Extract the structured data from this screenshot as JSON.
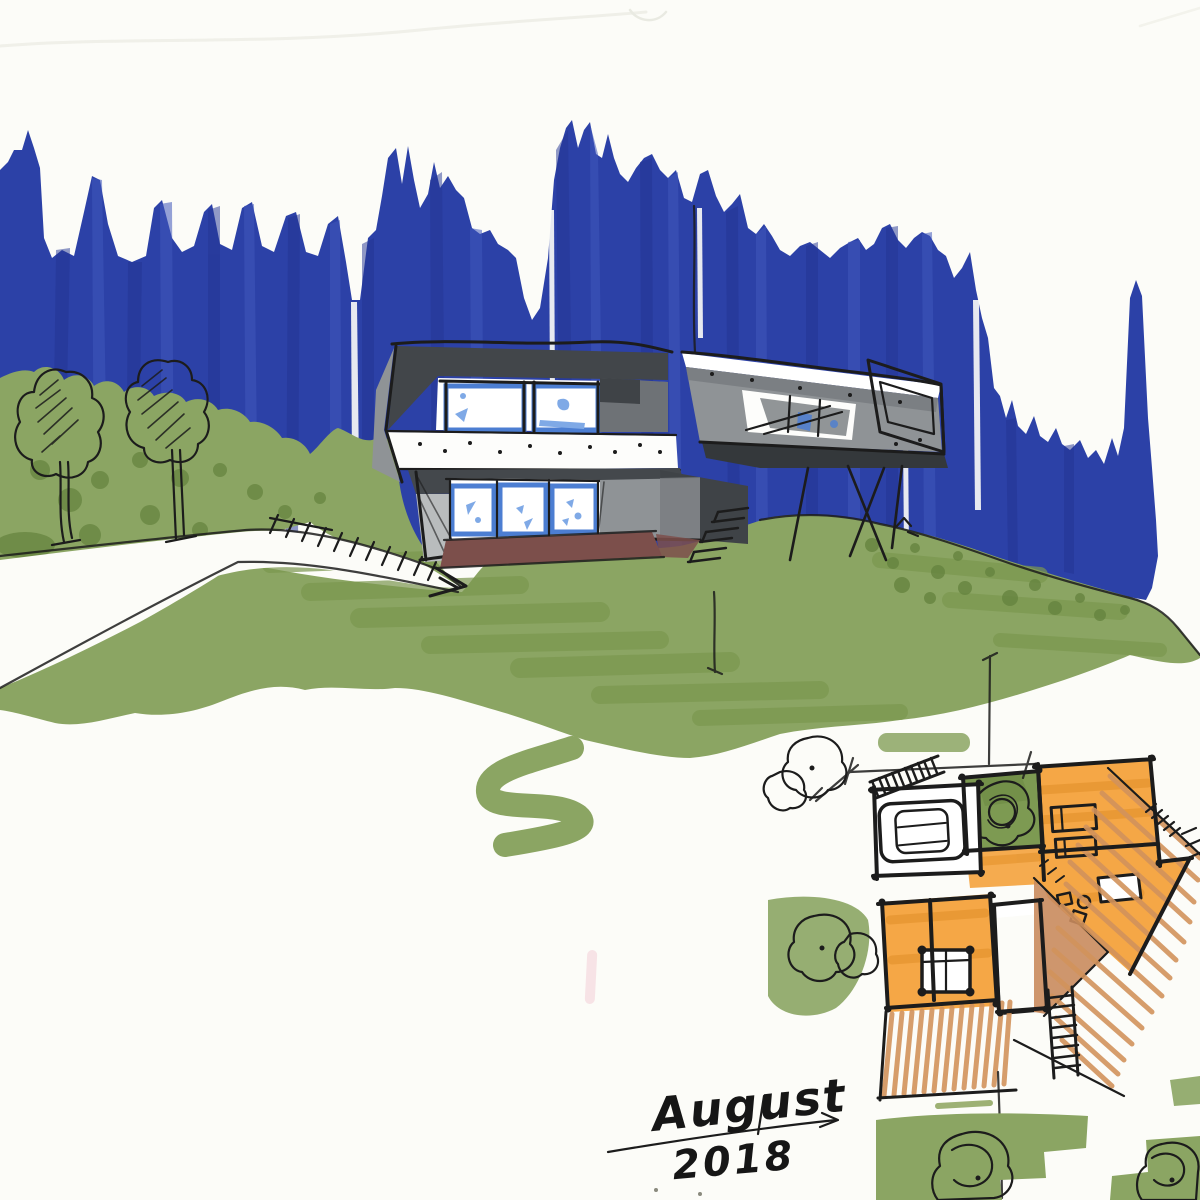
{
  "meta": {
    "kind": "hand-drawn architectural concept sketch",
    "medium": "marker and ink on white paper"
  },
  "signature": {
    "month": "August",
    "year": "2018"
  },
  "palette": {
    "paper": "#fcfcf8",
    "forest_blue": "#2c41a7",
    "forest_blue_dark": "#243593",
    "forest_blue_light": "#4058bb",
    "grass_green": "#8ba563",
    "grass_green_mid": "#7b974f",
    "grass_green_dark": "#66843f",
    "ink": "#1c1c1c",
    "roof_gray": "#42464a",
    "wall_gray": "#8f9396",
    "wall_gray_light": "#b9bcbd",
    "wall_gray_dark": "#3f4347",
    "window_blue": "#4c7ed2",
    "window_blue_light": "#7fa9e6",
    "terrace_brown": "#7c4f4b",
    "plan_orange": "#f4a23c",
    "plan_orange_deep": "#e18f28",
    "deck_tan": "#d2935c",
    "deck_tan_solid": "#c98b5d",
    "pool_blue": "#a3d7e9",
    "courtyard_green": "#7d9a52",
    "pink_smudge": "#f2c6d0"
  },
  "scene": {
    "elements": [
      "blue marker forest band",
      "green marker hillside and bushes",
      "white driveway with steps",
      "two ink trees",
      "modern two-story house elevation with cantilevered wing on stilts",
      "floor plan with garage, courtyard tree, orange rooms, pool, wood decks and stairs",
      "handwritten date signature with dimension arrow"
    ]
  }
}
